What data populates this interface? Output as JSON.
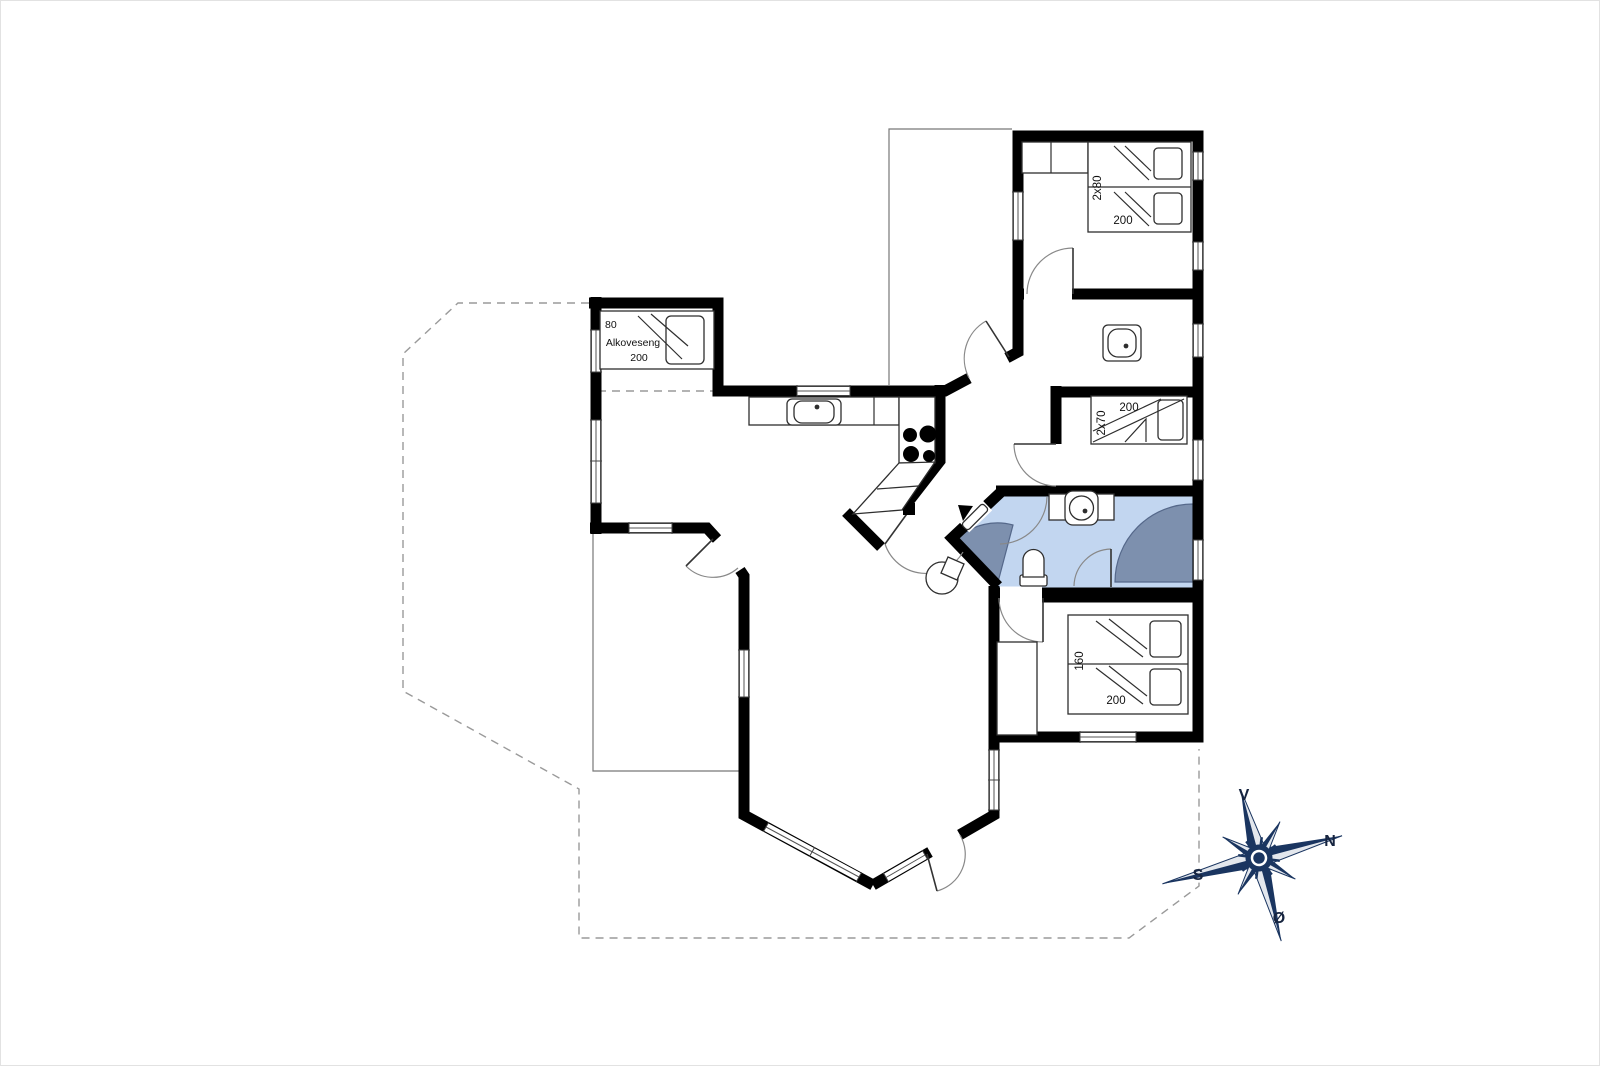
{
  "page": {
    "background": "#ffffff",
    "border_color": "#e2e2e2"
  },
  "plan": {
    "alcove_room": {
      "bed_width": "80",
      "bed_name": "Alkoveseng",
      "bed_length": "200"
    },
    "bedroom_top_right": {
      "bed_size": "2x80",
      "bed_length": "200"
    },
    "bedroom_bunk": {
      "bed_size": "2x70",
      "bed_length": "200"
    },
    "bedroom_double": {
      "bed_size": "160",
      "bed_length": "200"
    },
    "colors": {
      "wall": "#000000",
      "bathroom_floor": "#c2d6f0",
      "shower": "#7d90ae",
      "dashed_outline": "#9a9a9a",
      "thin_outline": "#777777",
      "door_arc": "#888888"
    }
  },
  "compass": {
    "top": "V",
    "right": "N",
    "left": "S",
    "bottom": "Ø",
    "color": "#1a3560",
    "label_color": "#16243f"
  }
}
